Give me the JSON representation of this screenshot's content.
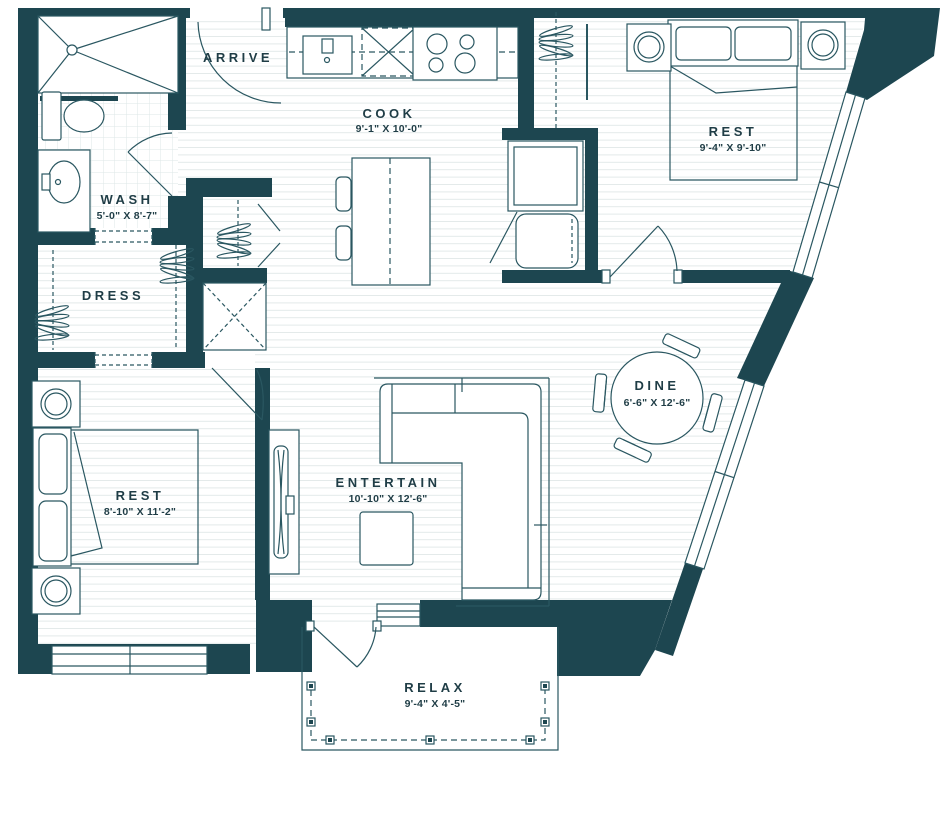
{
  "plan": {
    "rooms": {
      "arrive": {
        "label": "ARRIVE"
      },
      "cook": {
        "label": "COOK",
        "dims": "9'-1\" X 10'-0\""
      },
      "wash": {
        "label": "WASH",
        "dims": "5'-0\" X 8'-7\""
      },
      "dress": {
        "label": "DRESS"
      },
      "rest_upper": {
        "label": "REST",
        "dims": "9'-4\" X 9'-10\""
      },
      "rest_lower": {
        "label": "REST",
        "dims": "8'-10\" X 11'-2\""
      },
      "entertain": {
        "label": "ENTERTAIN",
        "dims": "10'-10\" X 12'-6\""
      },
      "dine": {
        "label": "DINE",
        "dims": "6'-6\" X 12'-6\""
      },
      "relax": {
        "label": "RELAX",
        "dims": "9'-4\" X 4'-5\""
      }
    },
    "colors": {
      "wall": "#1d4650",
      "line": "#2a5761",
      "text": "#1f3d46"
    }
  }
}
